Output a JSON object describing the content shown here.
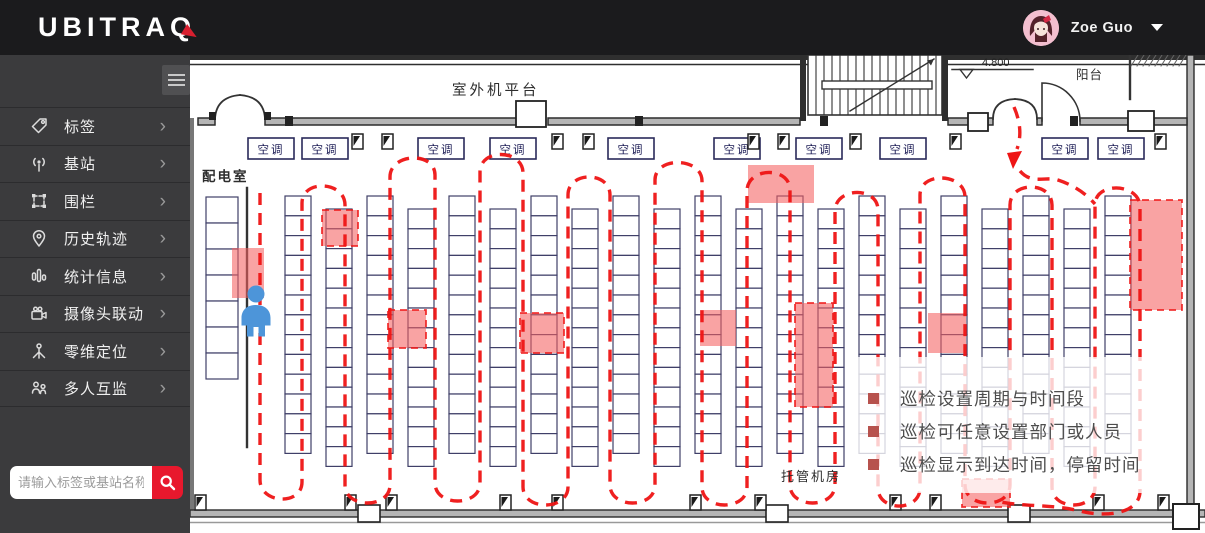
{
  "topbar": {
    "logo": "UBITRAQ",
    "user_name": "Zoe Guo"
  },
  "sidebar": {
    "menu": [
      {
        "label": "标签"
      },
      {
        "label": "基站"
      },
      {
        "label": "围栏"
      },
      {
        "label": "历史轨迹"
      },
      {
        "label": "统计信息"
      },
      {
        "label": "摄像头联动"
      },
      {
        "label": "零维定位"
      },
      {
        "label": "多人互监"
      }
    ],
    "search_placeholder": "请输入标签或基站名称"
  },
  "floorplan": {
    "labels": {
      "outdoor_platform": "室外机平台",
      "power_room": "配电室",
      "hosting_room": "托管机房",
      "balcony": "阳台",
      "elevation": "4.800",
      "ac_unit": "空调"
    },
    "annotations": [
      "巡检设置周期与时间段",
      "巡检可任意设置部门或人员",
      "巡检显示到达时间，停留时间"
    ],
    "colors": {
      "route_red": "#ee1414",
      "checkpoint_fill": "#f46060",
      "annotation_bullet": "#b7524d",
      "accent_red": "#e8182d"
    }
  }
}
